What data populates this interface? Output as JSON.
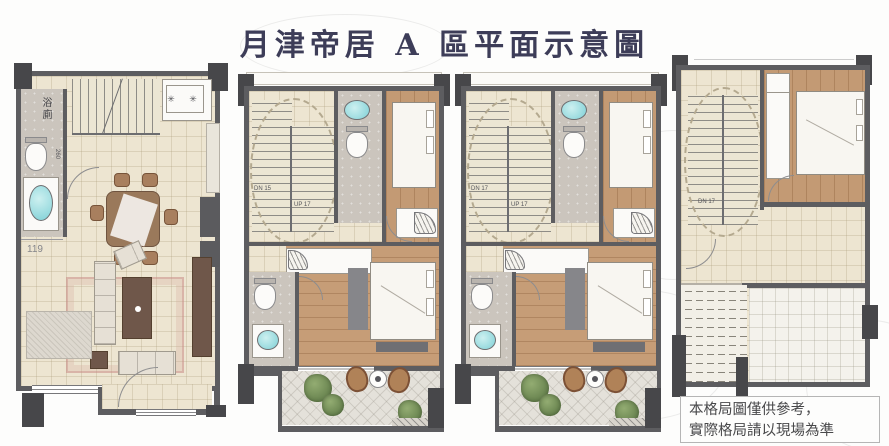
{
  "title": "月津帝居 A 區平面示意圖",
  "note": {
    "line1": "本格局圖僅供參考，",
    "line2": "實際格局請以現場為準"
  },
  "colors": {
    "title_text": "#3d3d58",
    "wall": "#5d5d60",
    "column": "#47474a",
    "tile_floor": "#ede5d1",
    "wood_floor": "#c39a74",
    "bath_floor": "#cbc5bd",
    "sink_basin": "#7fd0d6",
    "plant_green": "#55713f",
    "rug_accent": "#d4a298",
    "note_text": "#48484a"
  },
  "plans": [
    {
      "labels": {
        "bathroom": "浴廁",
        "bathroom_width": "260",
        "entry_width": "119",
        "stove_burners": "✳ ✳"
      }
    },
    {
      "labels": {
        "stair_down": "DN 15",
        "stair_up": "UP 17"
      }
    },
    {
      "labels": {
        "stair_down": "DN 17",
        "stair_up": "UP 17"
      }
    },
    {
      "labels": {
        "stair_down": "DN 17"
      }
    }
  ]
}
